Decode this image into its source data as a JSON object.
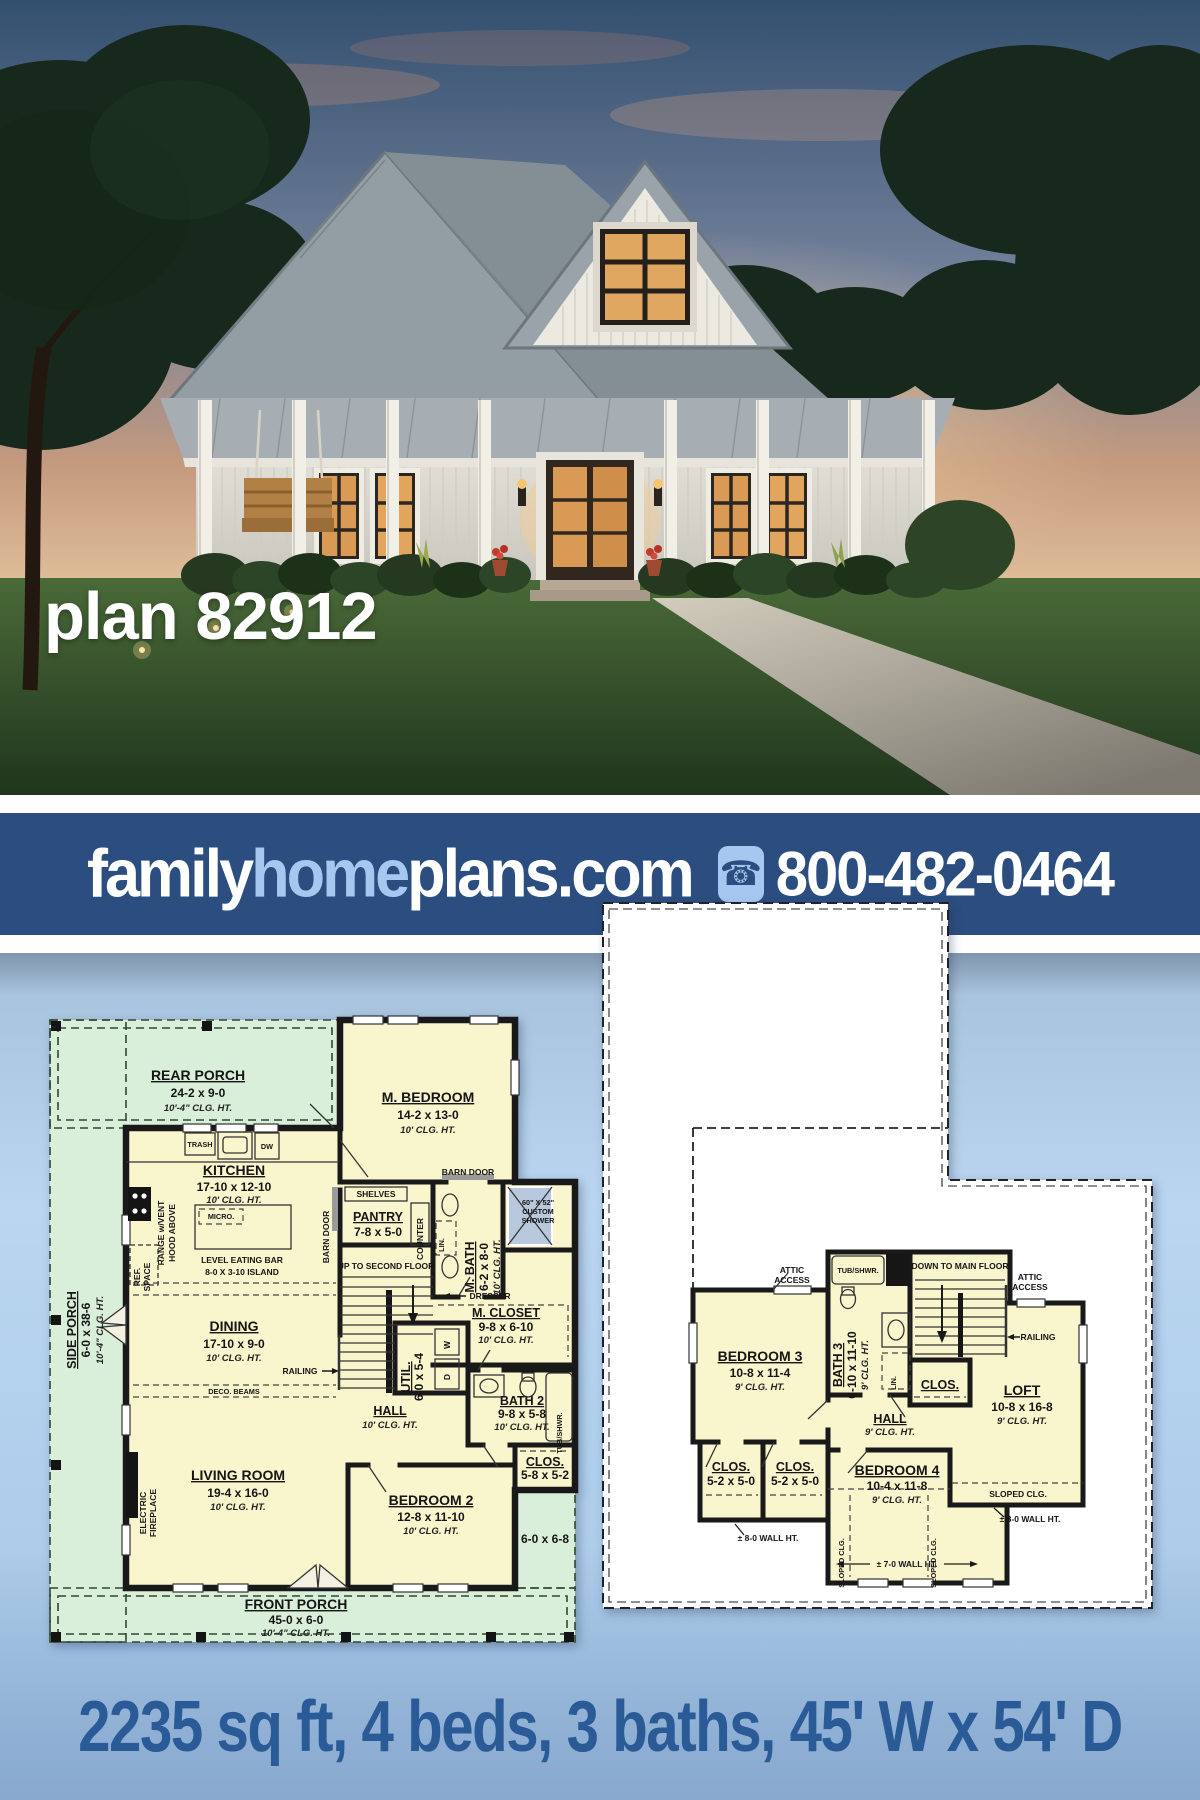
{
  "hero": {
    "plan_label": "plan 82912"
  },
  "banner": {
    "family": "family",
    "home": "home",
    "plans": "plans.com",
    "phone": "800-482-0464",
    "bg": "#2b4d7f",
    "accent": "#a6c8f0"
  },
  "footer": {
    "specs": "2235 sq ft, 4 beds, 3 baths, 45' W x 54' D",
    "color": "#2b5b97"
  },
  "colors": {
    "porch_green": "#d9efda",
    "room_yellow": "#f9f5cd",
    "shower_blue": "#b9c9dd",
    "plan_bg": "#bad6f0"
  },
  "f1": {
    "rear_porch": {
      "t": "REAR PORCH",
      "d": "24-2 x 9-0",
      "c": "10'-4\" CLG. HT."
    },
    "side_porch": {
      "t": "SIDE PORCH",
      "d": "6-0 x 38-6",
      "c": "10'-4\" CLG. HT."
    },
    "front_porch": {
      "t": "FRONT PORCH",
      "d": "45-0 x 6-0",
      "c": "10'-4\" CLG. HT."
    },
    "porch_wrap_dim": "6-0 x 6-8",
    "m_bedroom": {
      "t": "M. BEDROOM",
      "d": "14-2 x 13-0",
      "c": "10' CLG. HT."
    },
    "kitchen": {
      "t": "KITCHEN",
      "d": "17-10 x 12-10",
      "c": "10' CLG. HT."
    },
    "island": {
      "l1": "LEVEL EATING BAR",
      "l2": "8-0 X 3-10 ISLAND"
    },
    "trash": "TRASH",
    "dw": "DW",
    "micro": "MICRO.",
    "range": {
      "l1": "RANGE w/VENT",
      "l2": "HOOD ABOVE"
    },
    "ref": {
      "l1": "REF.",
      "l2": "SPACE"
    },
    "pantry": {
      "t": "PANTRY",
      "d": "7-8 x 5-0"
    },
    "shelves": "SHELVES",
    "counter": "COUNTER",
    "barn_door": "BARN DOOR",
    "m_bath": {
      "t": "M. BATH",
      "d": "6-2 x 8-0",
      "c": "10' CLG. HT."
    },
    "lin": "LIN.",
    "shower": {
      "l1": "60\" X 52\"",
      "l2": "CUSTOM",
      "l3": "SHOWER"
    },
    "m_closet": {
      "t": "M. CLOSET",
      "d": "9-8 x 6-10",
      "c": "10' CLG. HT."
    },
    "dresser": "DRESSER",
    "stairs": "UP TO SECOND FLOOR",
    "railing": "RAILING",
    "dining": {
      "t": "DINING",
      "d": "17-10 x 9-0",
      "c": "10' CLG. HT."
    },
    "deco_beams": "DECO. BEAMS",
    "util": {
      "t": "UTIL.",
      "d": "6-0 x 5-4"
    },
    "washer": "W",
    "dryer": "D",
    "hall": {
      "t": "HALL",
      "c": "10' CLG. HT."
    },
    "bath2": {
      "t": "BATH 2",
      "d": "9-8 x 5-8",
      "c": "10' CLG. HT."
    },
    "tub_shwr": "TUB/SHWR.",
    "clos": {
      "t": "CLOS.",
      "d": "5-8 x 5-2"
    },
    "living": {
      "t": "LIVING ROOM",
      "d": "19-4 x 16-0",
      "c": "10' CLG. HT."
    },
    "fireplace": {
      "l1": "ELECTRIC",
      "l2": "FIREPLACE"
    },
    "bedroom2": {
      "t": "BEDROOM 2",
      "d": "12-8 x 11-10",
      "c": "10' CLG. HT."
    }
  },
  "f2": {
    "bedroom3": {
      "t": "BEDROOM 3",
      "d": "10-8 x 11-4",
      "c": "9' CLG. HT."
    },
    "attic": {
      "l1": "ATTIC",
      "l2": "ACCESS"
    },
    "bath3": {
      "t": "BATH 3",
      "d": "6-10 x 11-10",
      "c": "9' CLG. HT."
    },
    "tub_shwr": "TUB/SHWR.",
    "lin": "LIN.",
    "stairs": "DOWN TO MAIN FLOOR",
    "clos_label": "CLOS.",
    "railing": "RAILING",
    "hall": {
      "t": "HALL",
      "c": "9' CLG. HT."
    },
    "clos": {
      "t": "CLOS.",
      "d": "5-2 x 5-0"
    },
    "bedroom4": {
      "t": "BEDROOM 4",
      "d": "10-4 x 11-8",
      "c": "9' CLG. HT."
    },
    "loft": {
      "t": "LOFT",
      "d": "10-8 x 16-8",
      "c": "9' CLG. HT."
    },
    "sloped": "SLOPED CLG.",
    "wall8": "± 8-0 WALL HT.",
    "wall7": "± 7-0 WALL HT."
  }
}
